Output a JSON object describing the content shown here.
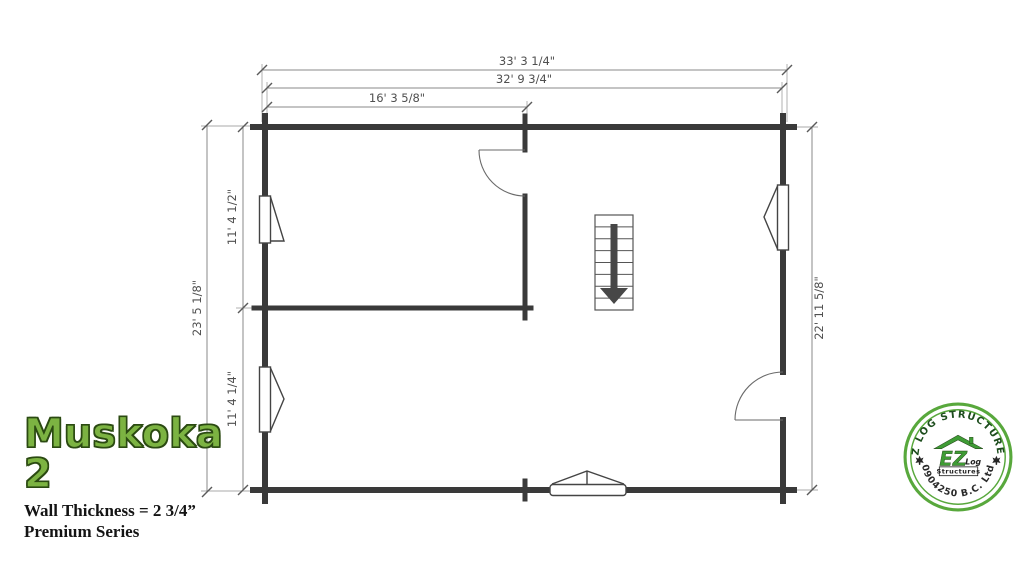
{
  "title_block": {
    "title": "Muskoka 2",
    "wall_thickness": "Wall Thickness = 2 3/4”",
    "series": "Premium Series"
  },
  "dimensions": {
    "top_overall": "33' 3 1/4\"",
    "top_inner": "32' 9 3/4\"",
    "top_left_room": "16' 3 5/8\"",
    "left_overall": "23' 5 1/8\"",
    "left_upper_room": "11' 4 1/2\"",
    "left_lower_room": "11' 4 1/4\"",
    "right_inner": "22' 11 5/8\""
  },
  "stairs": {
    "direction": "down",
    "tread_count": 8
  },
  "logo": {
    "arc_top": "EZ LOG STRUCTURES",
    "arc_bottom": "0904250 B.C. Ltd",
    "center_ez": "EZ",
    "center_log": "Log",
    "center_structures": "Structures"
  },
  "colors": {
    "wall": "#3a3a3a",
    "dimension_line": "#8a8a8a",
    "dimension_text": "#4f4f4f",
    "title_green": "#7cb342",
    "logo_green": "#3f9c35"
  }
}
